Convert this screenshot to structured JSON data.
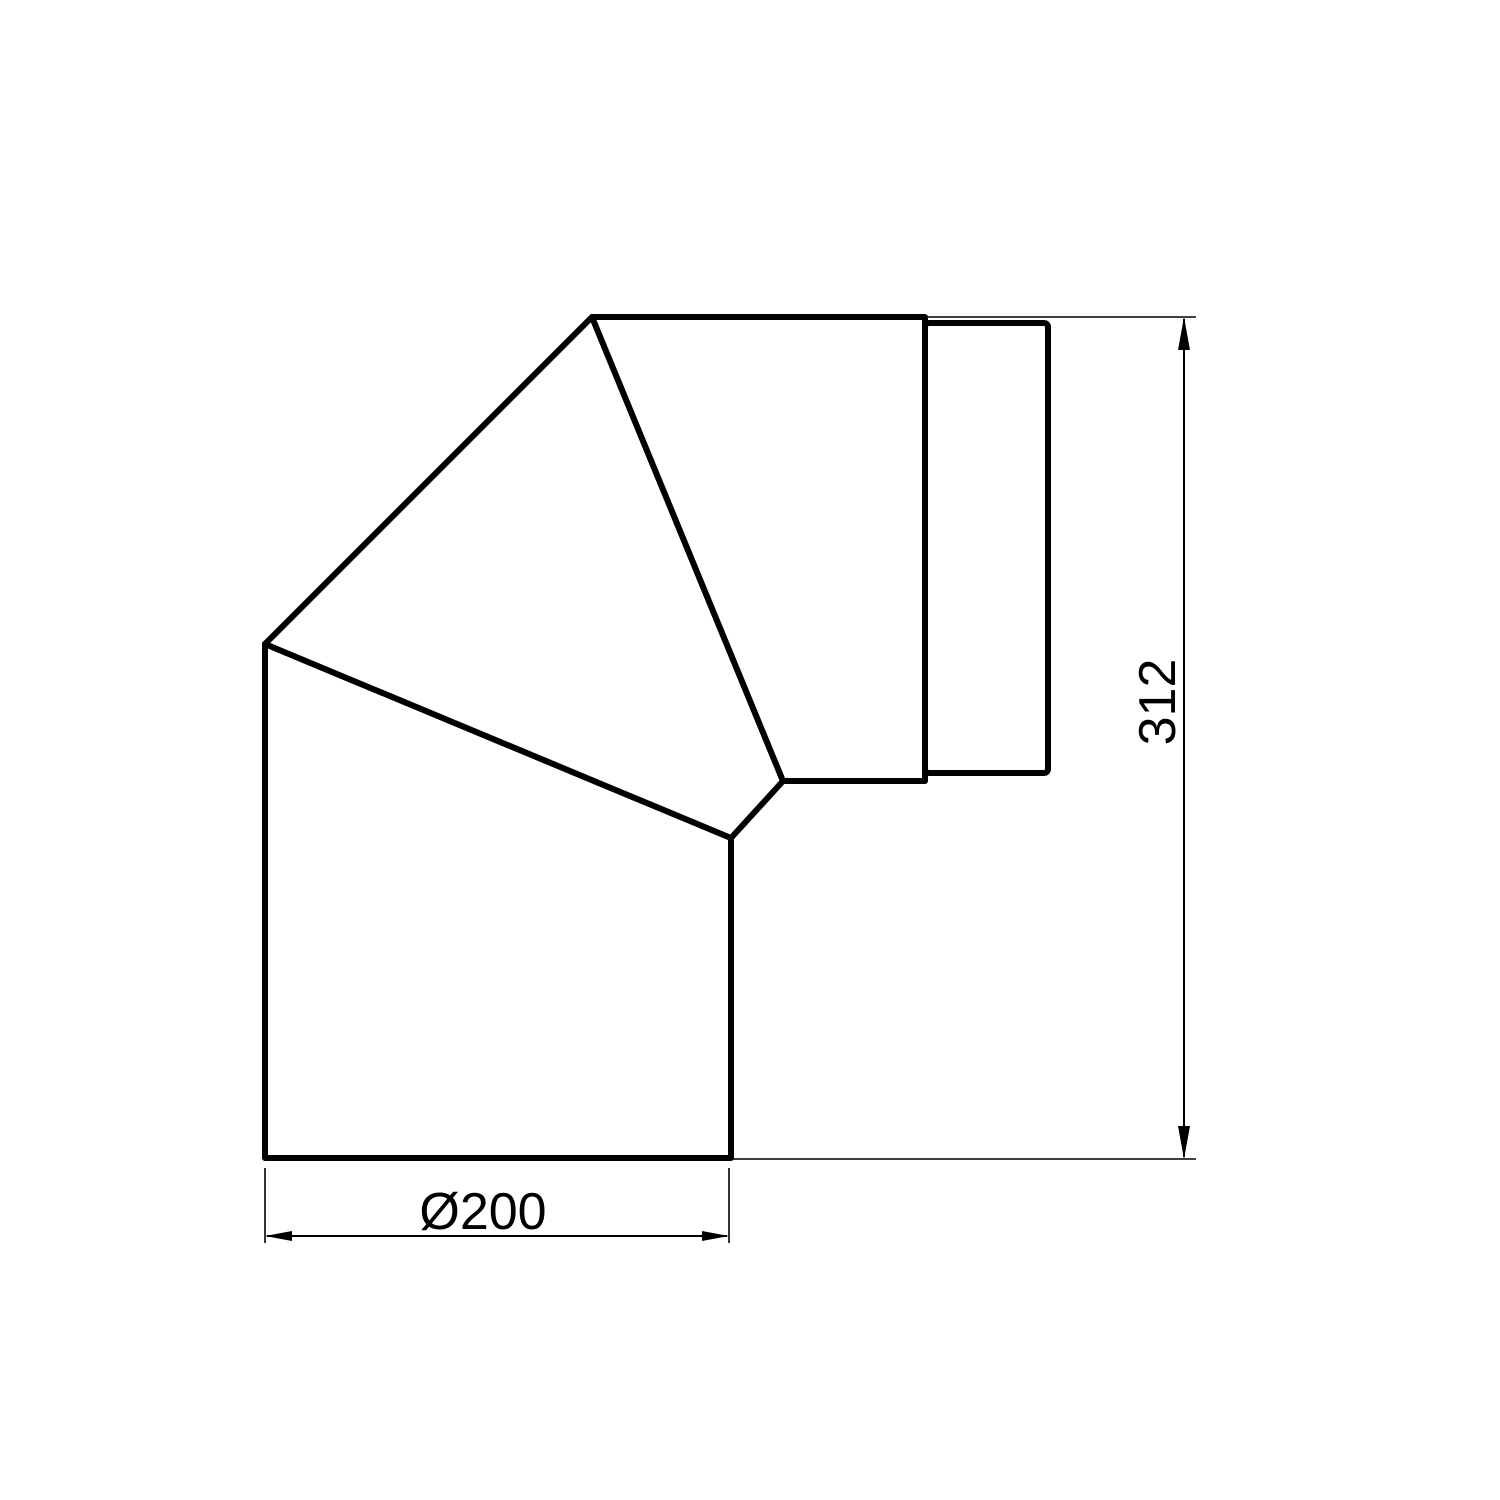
{
  "drawing": {
    "description": "Technical drawing of a mitered 90-degree pipe elbow with connector collar",
    "background_color": "#ffffff",
    "line_color": "#000000",
    "dimensions": [
      {
        "id": "overall-height",
        "label": "312",
        "orientation": "vertical"
      },
      {
        "id": "pipe-diameter",
        "label": "Ø200",
        "orientation": "horizontal"
      }
    ]
  }
}
